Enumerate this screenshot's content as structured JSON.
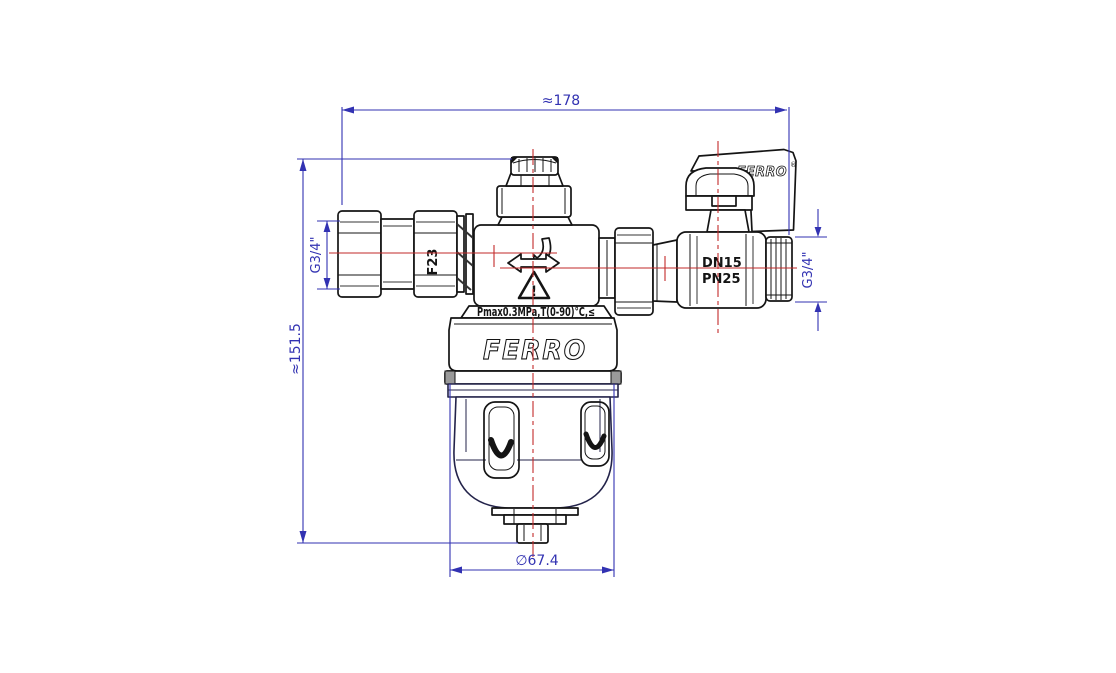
{
  "colors": {
    "dimension": "#3232b2",
    "centerline": "#c22a2a",
    "outline": "#141414",
    "shade": "#9a9a9a",
    "bowl": "#23234a",
    "background": "#ffffff"
  },
  "dimensions": {
    "overall_width": "≈178",
    "overall_height": "≈151.5",
    "bowl_diameter": "∅67.4",
    "inlet_thread": "G3/4\"",
    "outlet_thread": "G3/4\""
  },
  "markings": {
    "union_nut": "F23",
    "valve_size": "DN15",
    "valve_pressure": "PN25",
    "spec": "Pmax0.3MPa,T(0-90)°C,≤",
    "body_logo": "FERRO",
    "handle_logo": "FERRO",
    "handle_logo_reg": "®",
    "warning": "!"
  }
}
